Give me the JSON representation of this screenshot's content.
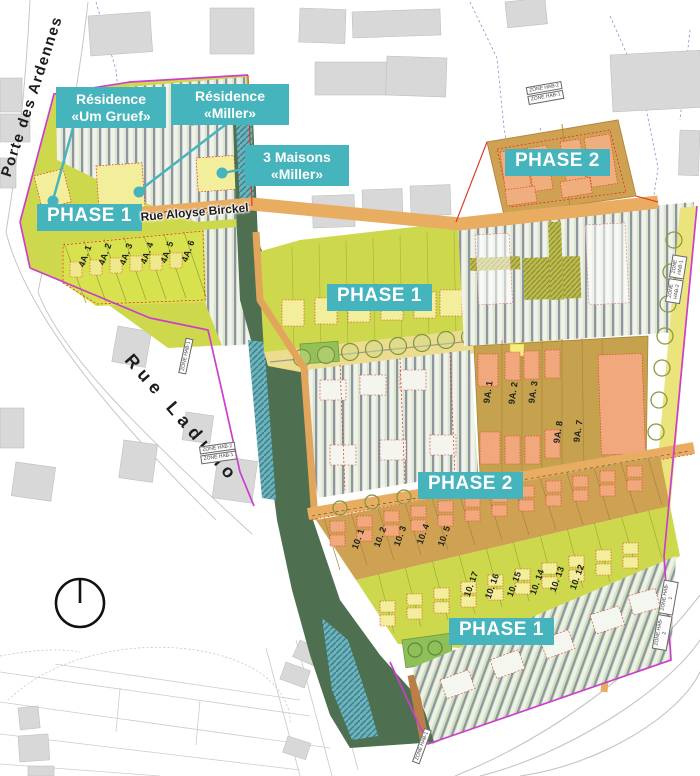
{
  "banners": {
    "phase1": "PHASE 1",
    "phase2": "PHASE 2"
  },
  "callouts": {
    "um_gruef": {
      "line1": "Résidence",
      "line2": "«Um Gruef»"
    },
    "miller": {
      "line1": "Résidence",
      "line2": "«Miller»"
    },
    "maisons_miller": {
      "line1": "3 Maisons",
      "line2": "«Miller»"
    }
  },
  "streets": {
    "porte_des_ardennes": "Porte des Ardennes",
    "rue_aloyse_birckel": "Rue Aloyse Birckel",
    "rue_laduno": "Rue Laduno"
  },
  "lots": {
    "block_4a": [
      "4A. 1",
      "4A. 2",
      "4A. 3",
      "4A. 4",
      "4A. 5",
      "4A. 6"
    ],
    "block_9a": [
      "9A. 1",
      "9A. 2",
      "9A. 3",
      "9A. 8",
      "9A. 7"
    ],
    "block_10_upper": [
      "10. 1",
      "10. 2",
      "10. 3",
      "10. 4",
      "10. 5"
    ],
    "block_10_lower": [
      "10. 17",
      "10. 16",
      "10. 15",
      "10. 14",
      "10. 13",
      "10. 12"
    ]
  },
  "zone_tags": {
    "hab2": "ZONE HAB-2",
    "hab1": "ZONE HAB-1"
  },
  "colors": {
    "phase_label_teal": "#45b4bc",
    "phase1_fill": "#cdd84c",
    "phase2_fill": "#cfa253",
    "corridor_green": "#4e7050",
    "water_teal": "#6fb3ba",
    "road_sand": "#e9ad62",
    "boundary_magenta": "#cc3fcc",
    "boundary_red": "#e03020",
    "existing_building_gray": "#d8d8d8"
  }
}
